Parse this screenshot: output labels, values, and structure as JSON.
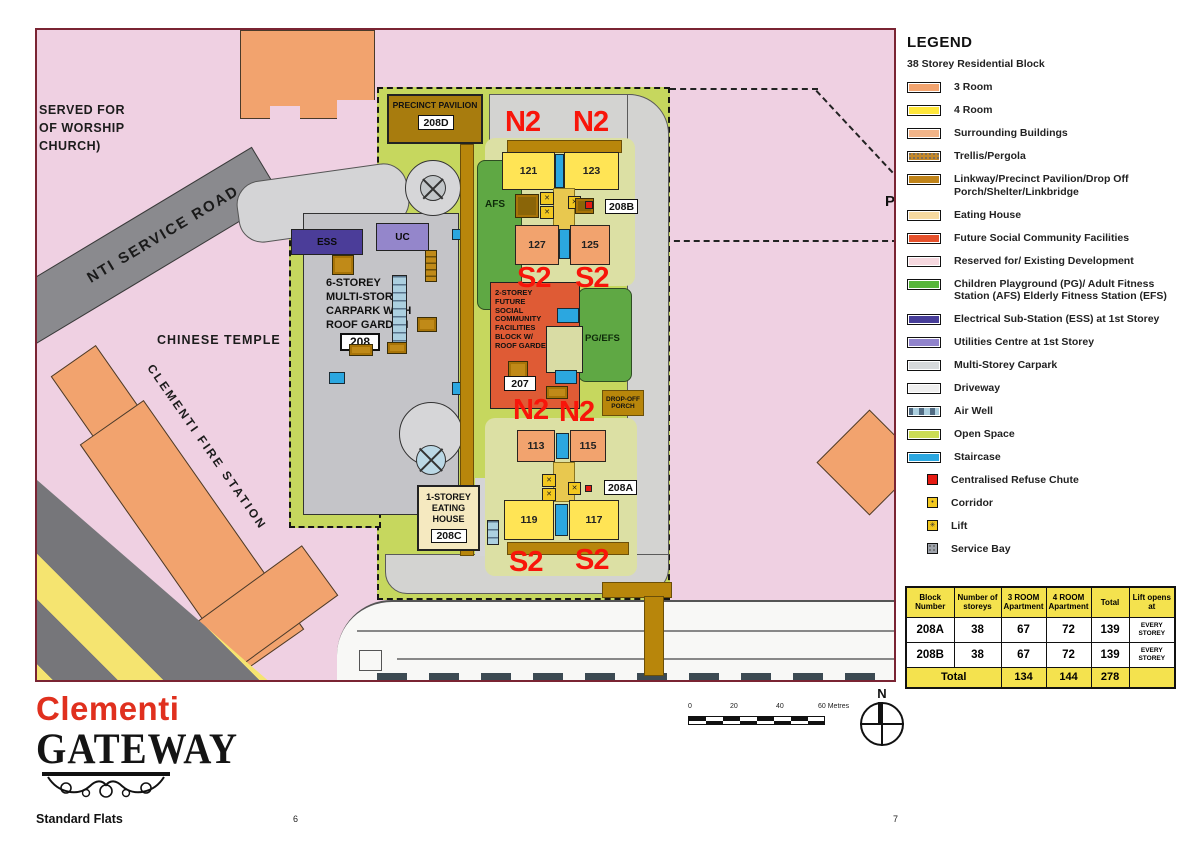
{
  "colors": {
    "stack_label_red": "#F8150A",
    "map_frame": "#7A2433",
    "open_space_green": "#C6D75E",
    "reserved_pink": "#EFD0E2"
  },
  "map": {
    "surroundings": {
      "worship_lines": [
        "SERVED FOR",
        "OF WORSHIP",
        "CHURCH)"
      ],
      "service_road": "NTI SERVICE ROAD",
      "chinese_temple": "CHINESE TEMPLE",
      "fire_station": "CLEMENTI FIRE STATION",
      "p_fragment": "P"
    },
    "site": {
      "pavilion_title": "PRECINCT PAVILION",
      "pavilion_code": "208D",
      "carpark_lines": [
        "6-STOREY",
        "MULTI-STOREY",
        "CARPARK WITH",
        "ROOF GARDEN"
      ],
      "carpark_code": "208",
      "ess": "ESS",
      "uc": "UC",
      "afs": "AFS",
      "pg_efs": "PG/EFS",
      "community_lines": [
        "2-STOREY FUTURE",
        "SOCIAL",
        "COMMUNITY",
        "FACILITIES",
        "BLOCK W/",
        "ROOF GARDEN"
      ],
      "community_code": "207",
      "dropoff_lines": [
        "DROP-OFF",
        "PORCH"
      ],
      "eating_lines": [
        "1-STOREY",
        "EATING",
        "HOUSE"
      ],
      "eating_code": "208C",
      "code_208a": "208A",
      "code_208b": "208B",
      "n2": "N2",
      "s2": "S2",
      "units": {
        "u121": "121",
        "u123": "123",
        "u127": "127",
        "u125": "125",
        "u113": "113",
        "u115": "115",
        "u119": "119",
        "u117": "117"
      }
    }
  },
  "legend": {
    "title": "LEGEND",
    "subtitle": "38 Storey Residential Block",
    "items": [
      {
        "label": "3 Room",
        "color": "#F2A36E"
      },
      {
        "label": "4 Room",
        "color": "#FFE73B"
      },
      {
        "label": "Surrounding Buildings",
        "color": "#F2B488"
      },
      {
        "label": "Trellis/Pergola",
        "color": "#C4882A"
      },
      {
        "label": "Linkway/Precinct Pavilion/Drop Off Porch/Shelter/Linkbridge",
        "color": "#C08318"
      },
      {
        "label": "Eating House",
        "color": "#F6D9A0"
      },
      {
        "label": "Future Social Community Facilities",
        "color": "#E5502B"
      },
      {
        "label": "Reserved for/ Existing Development",
        "color": "#F6D8DF"
      },
      {
        "label": "Children Playground (PG)/ Adult Fitness Station (AFS) Elderly Fitness Station (EFS)",
        "color": "#57B53A"
      },
      {
        "label": "Electrical Sub-Station (ESS) at 1st Storey",
        "color": "#473D99"
      },
      {
        "label": "Utilities Centre at 1st Storey",
        "color": "#9184CC"
      },
      {
        "label": "Multi-Storey Carpark",
        "color": "#D6D9DB"
      },
      {
        "label": "Driveway",
        "color": "#EFEFEF"
      },
      {
        "label": "Air Well",
        "color": "#ABCFDF"
      },
      {
        "label": "Open Space",
        "color": "#CBDC55"
      },
      {
        "label": "Staircase",
        "color": "#2BA7E0"
      }
    ],
    "small_items": [
      {
        "label": "Centralised Refuse Chute",
        "color": "#E61A12"
      },
      {
        "label": "Corridor",
        "color": "#F2C81F"
      },
      {
        "label": "Lift",
        "color": "#F2C81F"
      },
      {
        "label": "Service Bay",
        "color": "#9FA4AC"
      }
    ]
  },
  "table": {
    "headers": [
      "Block Number",
      "Number of storeys",
      "3 ROOM Apartment",
      "4 ROOM Apartment",
      "Total",
      "Lift opens at"
    ],
    "rows": [
      [
        "208A",
        "38",
        "67",
        "72",
        "139",
        "EVERY STOREY"
      ],
      [
        "208B",
        "38",
        "67",
        "72",
        "139",
        "EVERY STOREY"
      ]
    ],
    "total_label": "Total",
    "totals": [
      "134",
      "144",
      "278"
    ]
  },
  "scalebar": {
    "t0": "0",
    "t1": "20",
    "t2": "40",
    "t3": "60 Metres"
  },
  "compass_n": "N",
  "logo": {
    "name1": "Clementi",
    "name2": "GATEWAY",
    "subtitle": "Standard Flats"
  },
  "page_left": "6",
  "page_right": "7"
}
